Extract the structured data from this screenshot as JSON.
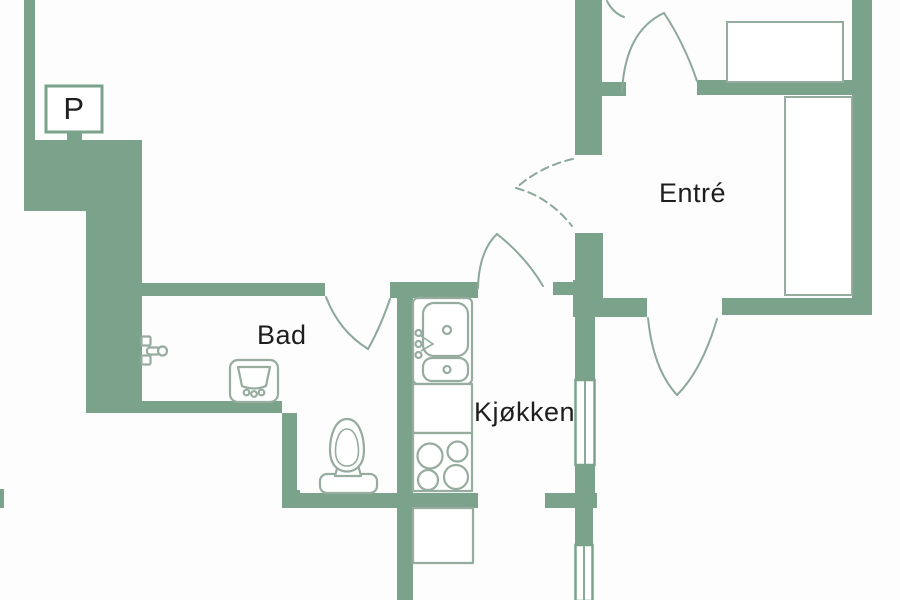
{
  "colors": {
    "wall": "#7ba28b",
    "fixture": "#96ac9e",
    "door": "#8ca89a",
    "text": "#1e1e1e",
    "background": "#fdfdfd"
  },
  "rooms": {
    "bathroom": {
      "label": "Bad"
    },
    "kitchen": {
      "label": "Kjøkken"
    },
    "entrance": {
      "label": "Entré"
    }
  },
  "signs": {
    "parking": {
      "label": "P"
    }
  },
  "fixtures": [
    "shower-mixer",
    "washbasin",
    "toilet",
    "kitchen-sink-double",
    "kitchen-counter",
    "stove-four-burners",
    "lower-counter",
    "wardrobe-top-room",
    "wardrobe-entrance"
  ],
  "windows": [
    "kitchen-east-window-upper",
    "kitchen-east-window-lower"
  ],
  "doors": [
    "entry-door",
    "hall-door-dashed",
    "kitchen-door",
    "bathroom-door",
    "south-room-door",
    "top-room-door-partial"
  ]
}
